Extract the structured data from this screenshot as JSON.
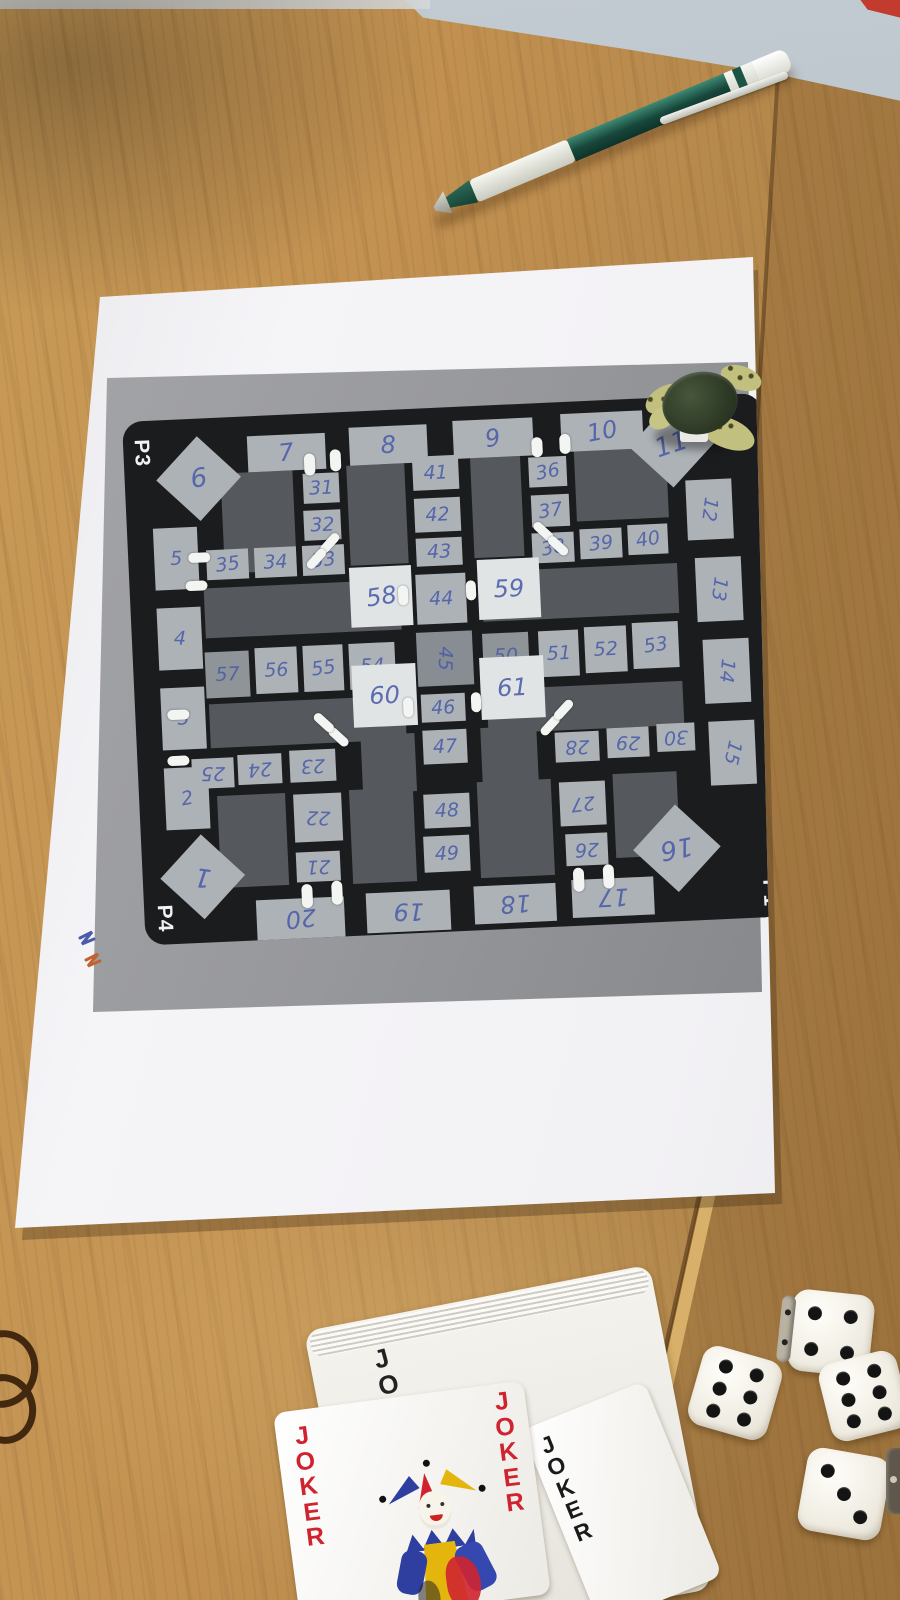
{
  "colors": {
    "wood": "#c29151",
    "paper": "#f5f4f7",
    "print_background": "#97989c",
    "board_black": "#1b1c1e",
    "track_cell": "#adb2b6",
    "special_cell": "#e1e4e5",
    "field_gray": "#55595d",
    "handwriting_ink": "#4a5ca9",
    "corner_label_white": "#f2f2f2",
    "joker_red": "#cf2430",
    "joker_black": "#1a1a1a",
    "pen_green": "#17473b",
    "tick_white": "#f3f5f3",
    "dice_white": "#ece8dd",
    "pip_black": "#141414"
  },
  "board": {
    "corner_labels": [
      {
        "text": "P3",
        "x": 4,
        "y": 20,
        "rot": 90
      },
      {
        "text": "P4",
        "x": 6,
        "y": 486,
        "rot": 90
      },
      {
        "text": "P1",
        "x": 612,
        "y": 488,
        "rot": 90
      }
    ],
    "fields": [
      [
        96,
        56,
        72,
        100
      ],
      [
        222,
        54,
        58,
        100
      ],
      [
        346,
        52,
        50,
        100
      ],
      [
        450,
        50,
        92,
        70
      ],
      [
        74,
        170,
        196,
        50
      ],
      [
        352,
        166,
        196,
        50
      ],
      [
        74,
        286,
        196,
        44
      ],
      [
        352,
        284,
        196,
        44
      ],
      [
        78,
        378,
        68,
        92
      ],
      [
        210,
        378,
        64,
        94
      ],
      [
        338,
        376,
        74,
        96
      ],
      [
        474,
        374,
        64,
        84
      ],
      [
        224,
        324,
        54,
        58
      ],
      [
        344,
        322,
        56,
        58
      ]
    ],
    "cells": [
      {
        "label": "1",
        "x": 30,
        "y": 428,
        "w": 60,
        "h": 60,
        "rot": 190,
        "kind": "diamond"
      },
      {
        "label": "2",
        "x": 26,
        "y": 348,
        "w": 44,
        "h": 62,
        "rot": -8,
        "kind": "track"
      },
      {
        "label": "3",
        "x": 26,
        "y": 268,
        "w": 44,
        "h": 62,
        "rot": 0,
        "kind": "track"
      },
      {
        "label": "4",
        "x": 26,
        "y": 188,
        "w": 44,
        "h": 62,
        "rot": 4,
        "kind": "track"
      },
      {
        "label": "5",
        "x": 26,
        "y": 108,
        "w": 44,
        "h": 62,
        "rot": 0,
        "kind": "track"
      },
      {
        "label": "6",
        "x": 44,
        "y": 30,
        "w": 60,
        "h": 60,
        "rot": -6,
        "kind": "diamond"
      },
      {
        "label": "7",
        "x": 124,
        "y": 20,
        "w": 78,
        "h": 36,
        "rot": -4,
        "kind": "track"
      },
      {
        "label": "8",
        "x": 226,
        "y": 16,
        "w": 78,
        "h": 38,
        "rot": 0,
        "kind": "track"
      },
      {
        "label": "9",
        "x": 330,
        "y": 14,
        "w": 80,
        "h": 38,
        "rot": -6,
        "kind": "track"
      },
      {
        "label": "10",
        "x": 438,
        "y": 12,
        "w": 82,
        "h": 38,
        "rot": -8,
        "kind": "track"
      },
      {
        "label": "11",
        "x": 518,
        "y": 18,
        "w": 60,
        "h": 60,
        "rot": -16,
        "kind": "diamond"
      },
      {
        "label": "12",
        "x": 560,
        "y": 84,
        "w": 46,
        "h": 60,
        "rot": 100,
        "kind": "track"
      },
      {
        "label": "13",
        "x": 566,
        "y": 162,
        "w": 46,
        "h": 64,
        "rot": 100,
        "kind": "track"
      },
      {
        "label": "14",
        "x": 570,
        "y": 244,
        "w": 46,
        "h": 64,
        "rot": 98,
        "kind": "track"
      },
      {
        "label": "15",
        "x": 572,
        "y": 326,
        "w": 46,
        "h": 64,
        "rot": 105,
        "kind": "track"
      },
      {
        "label": "16",
        "x": 504,
        "y": 420,
        "w": 62,
        "h": 62,
        "rot": 172,
        "kind": "diamond"
      },
      {
        "label": "17",
        "x": 428,
        "y": 478,
        "w": 82,
        "h": 38,
        "rot": 180,
        "kind": "track"
      },
      {
        "label": "18",
        "x": 330,
        "y": 480,
        "w": 82,
        "h": 38,
        "rot": 178,
        "kind": "track"
      },
      {
        "label": "19",
        "x": 222,
        "y": 482,
        "w": 84,
        "h": 40,
        "rot": 182,
        "kind": "track"
      },
      {
        "label": "20",
        "x": 112,
        "y": 484,
        "w": 88,
        "h": 40,
        "rot": 176,
        "kind": "track"
      },
      {
        "label": "21",
        "x": 154,
        "y": 438,
        "w": 44,
        "h": 30,
        "rot": 180,
        "kind": "inner"
      },
      {
        "label": "22",
        "x": 154,
        "y": 380,
        "w": 48,
        "h": 48,
        "rot": 184,
        "kind": "inner"
      },
      {
        "label": "23",
        "x": 152,
        "y": 336,
        "w": 46,
        "h": 32,
        "rot": 180,
        "kind": "inner"
      },
      {
        "label": "24",
        "x": 100,
        "y": 338,
        "w": 44,
        "h": 30,
        "rot": 178,
        "kind": "inner"
      },
      {
        "label": "25",
        "x": 54,
        "y": 340,
        "w": 42,
        "h": 30,
        "rot": 182,
        "kind": "inner"
      },
      {
        "label": "26",
        "x": 424,
        "y": 432,
        "w": 42,
        "h": 32,
        "rot": 180,
        "kind": "inner"
      },
      {
        "label": "27",
        "x": 420,
        "y": 380,
        "w": 46,
        "h": 44,
        "rot": 176,
        "kind": "inner"
      },
      {
        "label": "28",
        "x": 418,
        "y": 330,
        "w": 44,
        "h": 30,
        "rot": 180,
        "kind": "inner"
      },
      {
        "label": "29",
        "x": 470,
        "y": 328,
        "w": 42,
        "h": 30,
        "rot": 184,
        "kind": "inner"
      },
      {
        "label": "30",
        "x": 520,
        "y": 326,
        "w": 38,
        "h": 28,
        "rot": 180,
        "kind": "inner"
      },
      {
        "label": "31",
        "x": 178,
        "y": 60,
        "w": 36,
        "h": 30,
        "rot": 0,
        "kind": "inner"
      },
      {
        "label": "32",
        "x": 177,
        "y": 97,
        "w": 37,
        "h": 30,
        "rot": 0,
        "kind": "inner"
      },
      {
        "label": "33",
        "x": 174,
        "y": 132,
        "w": 42,
        "h": 30,
        "rot": -5,
        "kind": "inner"
      },
      {
        "label": "34",
        "x": 126,
        "y": 132,
        "w": 42,
        "h": 30,
        "rot": 0,
        "kind": "inner"
      },
      {
        "label": "35",
        "x": 78,
        "y": 132,
        "w": 42,
        "h": 30,
        "rot": -5,
        "kind": "inner"
      },
      {
        "label": "36",
        "x": 404,
        "y": 54,
        "w": 38,
        "h": 30,
        "rot": -8,
        "kind": "inner"
      },
      {
        "label": "37",
        "x": 405,
        "y": 92,
        "w": 38,
        "h": 32,
        "rot": -6,
        "kind": "inner"
      },
      {
        "label": "38",
        "x": 404,
        "y": 130,
        "w": 42,
        "h": 30,
        "rot": -8,
        "kind": "inner"
      },
      {
        "label": "39",
        "x": 452,
        "y": 128,
        "w": 42,
        "h": 30,
        "rot": -4,
        "kind": "inner"
      },
      {
        "label": "40",
        "x": 500,
        "y": 126,
        "w": 40,
        "h": 30,
        "rot": -6,
        "kind": "inner"
      },
      {
        "label": "41",
        "x": 288,
        "y": 48,
        "w": 46,
        "h": 34,
        "rot": 0,
        "kind": "inner"
      },
      {
        "label": "42",
        "x": 288,
        "y": 90,
        "w": 46,
        "h": 34,
        "rot": 0,
        "kind": "inner"
      },
      {
        "label": "43",
        "x": 288,
        "y": 130,
        "w": 46,
        "h": 28,
        "rot": 0,
        "kind": "inner"
      },
      {
        "label": "44",
        "x": 286,
        "y": 166,
        "w": 50,
        "h": 50,
        "rot": 0,
        "kind": "inner"
      },
      {
        "label": "45",
        "x": 284,
        "y": 224,
        "w": 56,
        "h": 54,
        "rot": 95,
        "kind": "center"
      },
      {
        "label": "46",
        "x": 286,
        "y": 286,
        "w": 44,
        "h": 28,
        "rot": 0,
        "kind": "inner"
      },
      {
        "label": "47",
        "x": 286,
        "y": 322,
        "w": 44,
        "h": 34,
        "rot": 0,
        "kind": "inner"
      },
      {
        "label": "48",
        "x": 284,
        "y": 386,
        "w": 46,
        "h": 34,
        "rot": 0,
        "kind": "inner"
      },
      {
        "label": "49",
        "x": 282,
        "y": 428,
        "w": 46,
        "h": 36,
        "rot": 0,
        "kind": "inner"
      },
      {
        "label": "50",
        "x": 350,
        "y": 228,
        "w": 46,
        "h": 46,
        "rot": 0,
        "kind": "dark"
      },
      {
        "label": "51",
        "x": 406,
        "y": 228,
        "w": 40,
        "h": 46,
        "rot": 0,
        "kind": "track"
      },
      {
        "label": "52",
        "x": 452,
        "y": 226,
        "w": 42,
        "h": 46,
        "rot": 0,
        "kind": "track"
      },
      {
        "label": "53",
        "x": 500,
        "y": 224,
        "w": 46,
        "h": 46,
        "rot": -6,
        "kind": "track"
      },
      {
        "label": "54",
        "x": 216,
        "y": 232,
        "w": 46,
        "h": 46,
        "rot": 0,
        "kind": "track"
      },
      {
        "label": "55",
        "x": 170,
        "y": 232,
        "w": 40,
        "h": 46,
        "rot": -5,
        "kind": "track"
      },
      {
        "label": "56",
        "x": 122,
        "y": 232,
        "w": 42,
        "h": 46,
        "rot": 0,
        "kind": "track"
      },
      {
        "label": "57",
        "x": 72,
        "y": 234,
        "w": 44,
        "h": 46,
        "rot": 0,
        "kind": "dark"
      },
      {
        "label": "58",
        "x": 220,
        "y": 156,
        "w": 62,
        "h": 60,
        "rot": -6,
        "kind": "special"
      },
      {
        "label": "59",
        "x": 348,
        "y": 154,
        "w": 62,
        "h": 60,
        "rot": 0,
        "kind": "special"
      },
      {
        "label": "60",
        "x": 218,
        "y": 254,
        "w": 64,
        "h": 62,
        "rot": 0,
        "kind": "special"
      },
      {
        "label": "61",
        "x": 346,
        "y": 252,
        "w": 64,
        "h": 62,
        "rot": 0,
        "kind": "special"
      }
    ],
    "ticks": [
      [
        180,
        40,
        11,
        22,
        0
      ],
      [
        206,
        37,
        11,
        22,
        0
      ],
      [
        408,
        34,
        11,
        20,
        0
      ],
      [
        436,
        32,
        11,
        20,
        0
      ],
      [
        60,
        134,
        22,
        10,
        0
      ],
      [
        56,
        162,
        22,
        10,
        0
      ],
      [
        32,
        290,
        22,
        10,
        0
      ],
      [
        30,
        336,
        22,
        10,
        0
      ],
      [
        158,
        470,
        11,
        24,
        0
      ],
      [
        188,
        468,
        11,
        24,
        0
      ],
      [
        430,
        466,
        11,
        24,
        0
      ],
      [
        460,
        464,
        11,
        24,
        0
      ],
      [
        190,
        126,
        24,
        9,
        -45
      ],
      [
        176,
        141,
        24,
        9,
        -45
      ],
      [
        404,
        124,
        24,
        9,
        45
      ],
      [
        418,
        139,
        24,
        9,
        45
      ],
      [
        190,
        320,
        24,
        9,
        45
      ],
      [
        176,
        305,
        24,
        9,
        45
      ],
      [
        402,
        318,
        24,
        9,
        -45
      ],
      [
        416,
        303,
        24,
        9,
        -45
      ],
      [
        268,
        176,
        10,
        20,
        0
      ],
      [
        336,
        174,
        10,
        20,
        0
      ],
      [
        268,
        288,
        10,
        20,
        0
      ],
      [
        336,
        286,
        10,
        20,
        0
      ]
    ]
  },
  "cards": {
    "front_left_label": "JOKER",
    "front_right_label": "JOKER",
    "black_card_label": "JOKER",
    "deck_partial_label": "JO"
  },
  "dice": {
    "items": [
      {
        "value": 6,
        "x": 694,
        "y": 1352,
        "size": 82,
        "rot": 16
      },
      {
        "value": 4,
        "x": 790,
        "y": 1292,
        "size": 82,
        "rot": 6,
        "side": true
      },
      {
        "value": 6,
        "x": 824,
        "y": 1356,
        "size": 80,
        "rot": -14
      },
      {
        "value": 3,
        "x": 802,
        "y": 1452,
        "size": 84,
        "rot": 10
      }
    ]
  }
}
